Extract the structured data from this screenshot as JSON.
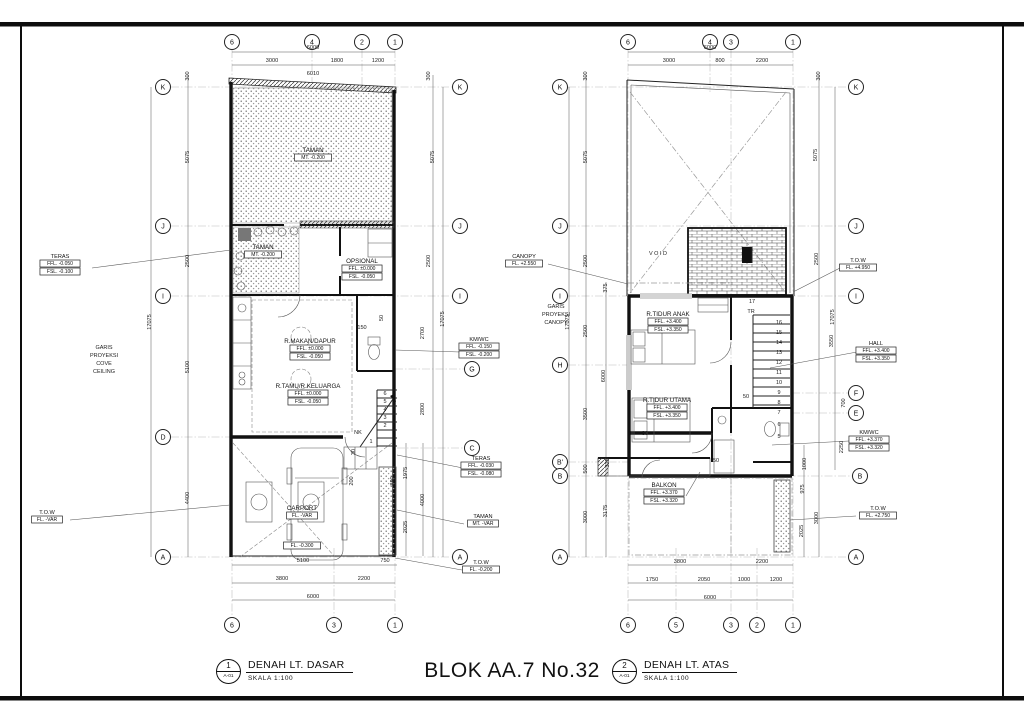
{
  "sheet": {
    "center_title": "BLOK AA.7 No.32",
    "views": [
      {
        "num": "1",
        "sheet": "A-01",
        "title": "DENAH LT. DASAR",
        "scale": "SKALA 1:100"
      },
      {
        "num": "2",
        "sheet": "A-01",
        "title": "DENAH LT. ATAS",
        "scale": "SKALA 1:100"
      }
    ]
  },
  "plans": [
    {
      "id": "ground-floor",
      "bubbles": [
        {
          "l": "6",
          "x": 232,
          "y": 42
        },
        {
          "l": "4",
          "x": 312,
          "y": 42
        },
        {
          "l": "2",
          "x": 362,
          "y": 42
        },
        {
          "l": "1",
          "x": 395,
          "y": 42
        },
        {
          "l": "6",
          "x": 232,
          "y": 625
        },
        {
          "l": "3",
          "x": 334,
          "y": 625
        },
        {
          "l": "1",
          "x": 395,
          "y": 625
        },
        {
          "l": "K",
          "x": 163,
          "y": 87
        },
        {
          "l": "J",
          "x": 163,
          "y": 226
        },
        {
          "l": "I",
          "x": 163,
          "y": 296
        },
        {
          "l": "D",
          "x": 163,
          "y": 437
        },
        {
          "l": "A",
          "x": 163,
          "y": 557
        },
        {
          "l": "K",
          "x": 460,
          "y": 87
        },
        {
          "l": "J",
          "x": 460,
          "y": 226
        },
        {
          "l": "I",
          "x": 460,
          "y": 296
        },
        {
          "l": "G",
          "x": 472,
          "y": 369
        },
        {
          "l": "C",
          "x": 472,
          "y": 448
        },
        {
          "l": "A",
          "x": 460,
          "y": 557
        }
      ],
      "dims": [
        {
          "t": "6000",
          "x": 313,
          "y": 49
        },
        {
          "t": "3000",
          "x": 272,
          "y": 62
        },
        {
          "t": "1800",
          "x": 337,
          "y": 62
        },
        {
          "t": "1200",
          "x": 378,
          "y": 62
        },
        {
          "t": "6010",
          "x": 313,
          "y": 75
        },
        {
          "t": "300",
          "x": 189,
          "y": 76,
          "r": 1
        },
        {
          "t": "5075",
          "x": 189,
          "y": 157,
          "r": 1
        },
        {
          "t": "2500",
          "x": 189,
          "y": 261,
          "r": 1
        },
        {
          "t": "5100",
          "x": 189,
          "y": 367,
          "r": 1
        },
        {
          "t": "4400",
          "x": 189,
          "y": 498,
          "r": 1
        },
        {
          "t": "17075",
          "x": 151,
          "y": 322,
          "r": 1
        },
        {
          "t": "300",
          "x": 430,
          "y": 76,
          "r": 1
        },
        {
          "t": "5075",
          "x": 434,
          "y": 157,
          "r": 1
        },
        {
          "t": "2500",
          "x": 430,
          "y": 261,
          "r": 1
        },
        {
          "t": "2700",
          "x": 424,
          "y": 333,
          "r": 1
        },
        {
          "t": "2800",
          "x": 424,
          "y": 409,
          "r": 1
        },
        {
          "t": "17075",
          "x": 444,
          "y": 319,
          "r": 1
        },
        {
          "t": "1975",
          "x": 407,
          "y": 473,
          "r": 1
        },
        {
          "t": "4000",
          "x": 424,
          "y": 500,
          "r": 1
        },
        {
          "t": "2025",
          "x": 407,
          "y": 527,
          "r": 1
        },
        {
          "t": "890",
          "x": 394,
          "y": 481,
          "r": 1
        },
        {
          "t": "200",
          "x": 353,
          "y": 481,
          "r": 1
        },
        {
          "t": "30",
          "x": 355,
          "y": 452,
          "r": 1
        },
        {
          "t": "150",
          "x": 362,
          "y": 329
        },
        {
          "t": "50",
          "x": 383,
          "y": 318,
          "r": 1
        },
        {
          "t": "5100",
          "x": 303,
          "y": 562
        },
        {
          "t": "750",
          "x": 385,
          "y": 562
        },
        {
          "t": "3800",
          "x": 282,
          "y": 580
        },
        {
          "t": "2200",
          "x": 364,
          "y": 580
        },
        {
          "t": "6000",
          "x": 313,
          "y": 598
        }
      ],
      "rooms": [
        {
          "n": "TAMAN",
          "x": 313,
          "y": 152,
          "lines": [
            "MT. -0.200"
          ]
        },
        {
          "n": "TAMAN",
          "x": 263,
          "y": 249,
          "lines": [
            "MT. -0.200"
          ]
        },
        {
          "n": "OPSIONAL",
          "x": 362,
          "y": 263,
          "lines": [
            "FFL. ±0.000",
            "FSL. -0.050"
          ]
        },
        {
          "n": "R.MAKAN/DAPUR",
          "x": 310,
          "y": 343,
          "lines": [
            "FFL. ±0.000",
            "FSL. -0.050"
          ]
        },
        {
          "n": "R.TAMU/R.KELUARGA",
          "x": 308,
          "y": 388,
          "lines": [
            "FFL. ±0.000",
            "FSL. -0.050"
          ]
        },
        {
          "n": "CARPORT",
          "x": 302,
          "y": 510,
          "lines": [
            "FL. -VAR"
          ]
        },
        {
          "n": "",
          "x": 302,
          "y": 547,
          "lines": [
            "FL. -0.300"
          ]
        }
      ],
      "ann": [
        {
          "n": "TERAS",
          "x": 60,
          "y": 258,
          "lines": [
            "FFL. -0.050",
            "FSL. -0.100"
          ]
        },
        {
          "n": "T.O.W",
          "x": 47,
          "y": 514,
          "lines": [
            "FL. -VAR"
          ]
        },
        {
          "n": "KM/WC",
          "x": 479,
          "y": 341,
          "lines": [
            "FFL. -0.150",
            "FSL. -0.200"
          ]
        },
        {
          "n": "TERAS",
          "x": 481,
          "y": 460,
          "lines": [
            "FFL. -0.030",
            "FSL. -0.080"
          ]
        },
        {
          "n": "TAMAN",
          "x": 483,
          "y": 518,
          "lines": [
            "MT. -VAR"
          ]
        },
        {
          "n": "T.O.W",
          "x": 481,
          "y": 564,
          "lines": [
            "FL. -0.200"
          ]
        }
      ],
      "texts": [
        {
          "t": "GARIS",
          "x": 104,
          "y": 349
        },
        {
          "t": "PROYEKSI",
          "x": 104,
          "y": 357
        },
        {
          "t": "COVE",
          "x": 104,
          "y": 365
        },
        {
          "t": "CEILING",
          "x": 104,
          "y": 373
        },
        {
          "t": "6",
          "x": 385,
          "y": 395
        },
        {
          "t": "5",
          "x": 385,
          "y": 403
        },
        {
          "t": "4",
          "x": 385,
          "y": 411
        },
        {
          "t": "3",
          "x": 385,
          "y": 419
        },
        {
          "t": "2",
          "x": 385,
          "y": 427
        },
        {
          "t": "1",
          "x": 371,
          "y": 443
        },
        {
          "t": "NK",
          "x": 358,
          "y": 434
        }
      ]
    },
    {
      "id": "upper-floor",
      "bubbles": [
        {
          "l": "6",
          "x": 628,
          "y": 42
        },
        {
          "l": "4",
          "x": 710,
          "y": 42
        },
        {
          "l": "3",
          "x": 731,
          "y": 42
        },
        {
          "l": "1",
          "x": 793,
          "y": 42
        },
        {
          "l": "6",
          "x": 628,
          "y": 625
        },
        {
          "l": "5",
          "x": 676,
          "y": 625
        },
        {
          "l": "3",
          "x": 731,
          "y": 625
        },
        {
          "l": "2",
          "x": 757,
          "y": 625
        },
        {
          "l": "1",
          "x": 793,
          "y": 625
        },
        {
          "l": "K",
          "x": 560,
          "y": 87
        },
        {
          "l": "J",
          "x": 560,
          "y": 226
        },
        {
          "l": "I",
          "x": 560,
          "y": 296
        },
        {
          "l": "H",
          "x": 560,
          "y": 365
        },
        {
          "l": "B'",
          "x": 560,
          "y": 462
        },
        {
          "l": "B",
          "x": 560,
          "y": 476
        },
        {
          "l": "A",
          "x": 560,
          "y": 557
        },
        {
          "l": "K",
          "x": 856,
          "y": 87
        },
        {
          "l": "J",
          "x": 856,
          "y": 226
        },
        {
          "l": "I",
          "x": 856,
          "y": 296
        },
        {
          "l": "F",
          "x": 856,
          "y": 393
        },
        {
          "l": "E",
          "x": 856,
          "y": 413
        },
        {
          "l": "B",
          "x": 860,
          "y": 476
        },
        {
          "l": "A",
          "x": 856,
          "y": 557
        }
      ],
      "dims": [
        {
          "t": "6000",
          "x": 710,
          "y": 49
        },
        {
          "t": "3000",
          "x": 669,
          "y": 62
        },
        {
          "t": "800",
          "x": 720,
          "y": 62
        },
        {
          "t": "2200",
          "x": 762,
          "y": 62
        },
        {
          "t": "300",
          "x": 587,
          "y": 76,
          "r": 1
        },
        {
          "t": "5075",
          "x": 587,
          "y": 157,
          "r": 1
        },
        {
          "t": "2500",
          "x": 587,
          "y": 261,
          "r": 1
        },
        {
          "t": "2500",
          "x": 587,
          "y": 331,
          "r": 1
        },
        {
          "t": "3500",
          "x": 587,
          "y": 414,
          "r": 1
        },
        {
          "t": "500",
          "x": 587,
          "y": 469,
          "r": 1
        },
        {
          "t": "3000",
          "x": 587,
          "y": 517,
          "r": 1
        },
        {
          "t": "17075",
          "x": 569,
          "y": 322,
          "r": 1
        },
        {
          "t": "375",
          "x": 607,
          "y": 288,
          "r": 1
        },
        {
          "t": "6000",
          "x": 605,
          "y": 376,
          "r": 1
        },
        {
          "t": "325",
          "x": 609,
          "y": 463,
          "r": 1
        },
        {
          "t": "3175",
          "x": 607,
          "y": 511,
          "r": 1
        },
        {
          "t": "300",
          "x": 820,
          "y": 76,
          "r": 1
        },
        {
          "t": "5075",
          "x": 817,
          "y": 155,
          "r": 1
        },
        {
          "t": "2500",
          "x": 818,
          "y": 259,
          "r": 1
        },
        {
          "t": "17075",
          "x": 834,
          "y": 317,
          "r": 1
        },
        {
          "t": "3550",
          "x": 833,
          "y": 341,
          "r": 1
        },
        {
          "t": "700",
          "x": 845,
          "y": 403,
          "r": 1
        },
        {
          "t": "2250",
          "x": 843,
          "y": 447,
          "r": 1
        },
        {
          "t": "1000",
          "x": 806,
          "y": 464,
          "r": 1
        },
        {
          "t": "975",
          "x": 804,
          "y": 489,
          "r": 1
        },
        {
          "t": "3000",
          "x": 818,
          "y": 518,
          "r": 1
        },
        {
          "t": "2025",
          "x": 803,
          "y": 531,
          "r": 1
        },
        {
          "t": "50",
          "x": 746,
          "y": 398
        },
        {
          "t": "30",
          "x": 645,
          "y": 435
        },
        {
          "t": "50",
          "x": 716,
          "y": 462
        },
        {
          "t": "3800",
          "x": 680,
          "y": 563
        },
        {
          "t": "2200",
          "x": 762,
          "y": 563
        },
        {
          "t": "1750",
          "x": 652,
          "y": 581
        },
        {
          "t": "2050",
          "x": 704,
          "y": 581
        },
        {
          "t": "1000",
          "x": 744,
          "y": 581
        },
        {
          "t": "1200",
          "x": 776,
          "y": 581
        },
        {
          "t": "6000",
          "x": 710,
          "y": 599
        }
      ],
      "rooms": [
        {
          "n": "R.TIDUR ANAK",
          "x": 668,
          "y": 316,
          "lines": [
            "FFL. +3.400",
            "FSL. +3.350"
          ]
        },
        {
          "n": "R.TIDUR UTAMA",
          "x": 667,
          "y": 402,
          "lines": [
            "FFL. +3.400",
            "FSL. +3.350"
          ]
        },
        {
          "n": "BALKON",
          "x": 664,
          "y": 487,
          "lines": [
            "FFL. +3.370",
            "FSL. +3.320"
          ]
        }
      ],
      "ann": [
        {
          "n": "CANOPY",
          "x": 524,
          "y": 258,
          "lines": [
            "FL. +2.550"
          ]
        },
        {
          "n": "T.O.W",
          "x": 858,
          "y": 262,
          "lines": [
            "FL. +4.950"
          ]
        },
        {
          "n": "HALL",
          "x": 876,
          "y": 345,
          "lines": [
            "FFL. +3.400",
            "FSL. +3.350"
          ]
        },
        {
          "n": "KM/WC",
          "x": 869,
          "y": 434,
          "lines": [
            "FFL. +3.370",
            "FSL. +3.320"
          ]
        },
        {
          "n": "T.O.W",
          "x": 878,
          "y": 510,
          "lines": [
            "FL. +2.750"
          ]
        }
      ],
      "texts": [
        {
          "t": "V O I D",
          "x": 658,
          "y": 255
        },
        {
          "t": "GARIS",
          "x": 556,
          "y": 308
        },
        {
          "t": "PROYEKSI",
          "x": 556,
          "y": 316
        },
        {
          "t": "CANOPY",
          "x": 556,
          "y": 324
        },
        {
          "t": "17",
          "x": 752,
          "y": 303
        },
        {
          "t": "TR",
          "x": 751,
          "y": 313
        },
        {
          "t": "16",
          "x": 779,
          "y": 324
        },
        {
          "t": "15",
          "x": 779,
          "y": 334
        },
        {
          "t": "14",
          "x": 779,
          "y": 344
        },
        {
          "t": "13",
          "x": 779,
          "y": 354
        },
        {
          "t": "12",
          "x": 779,
          "y": 364
        },
        {
          "t": "11",
          "x": 779,
          "y": 374
        },
        {
          "t": "10",
          "x": 779,
          "y": 384
        },
        {
          "t": "9",
          "x": 779,
          "y": 394
        },
        {
          "t": "8",
          "x": 779,
          "y": 404
        },
        {
          "t": "7",
          "x": 779,
          "y": 414
        },
        {
          "t": "6",
          "x": 779,
          "y": 426
        },
        {
          "t": "5",
          "x": 779,
          "y": 438
        }
      ]
    }
  ]
}
